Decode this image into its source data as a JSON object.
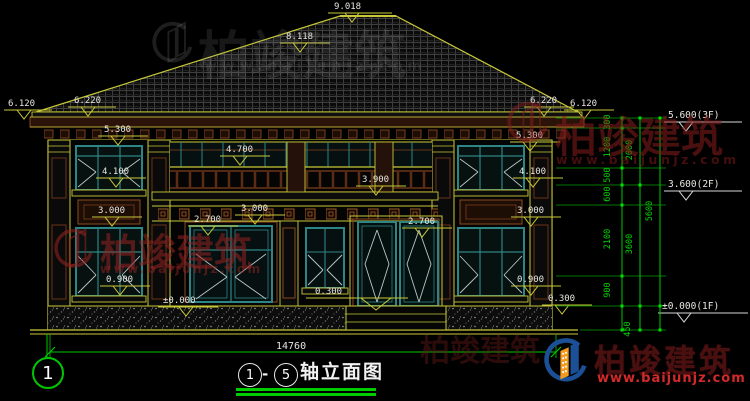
{
  "drawing_title": {
    "axis_start": "1",
    "axis_separator": "-",
    "axis_end": "5",
    "name": "轴立面图",
    "total_width": "14760",
    "axis_bubble": "1"
  },
  "dims": {
    "top": [
      "9.018",
      "8.118"
    ],
    "left": [
      "6.120",
      "6.220",
      "5.300",
      "4.100",
      "3.000",
      "0.900",
      "±0.000"
    ],
    "center": [
      "4.700",
      "3.900",
      "3.000",
      "2.700",
      "0.300",
      "2.700"
    ],
    "right": [
      "6.220",
      "6.120",
      "5.300",
      "4.100",
      "3.000",
      "0.900",
      "0.300"
    ]
  },
  "levels": [
    "5.600(3F)",
    "3.600(2F)",
    "±0.000(1F)"
  ],
  "chain": {
    "inner": [
      "300",
      "1200",
      "500",
      "600",
      "2100",
      "900",
      "450"
    ],
    "middle": [
      "2000",
      "3600"
    ],
    "outer": [
      "5600"
    ]
  },
  "brand": {
    "name": "柏竣建筑",
    "url": "www.baijunjz.com"
  },
  "colors": {
    "cad_yellow": "#c8c838",
    "frame_teal": "#2e8585",
    "trim_brown": "#8a4a22",
    "dim_green": "#00c800",
    "text_white": "#e8e6e0",
    "brand_red": "#d22a2a",
    "brand_dark": "#4a1010"
  }
}
